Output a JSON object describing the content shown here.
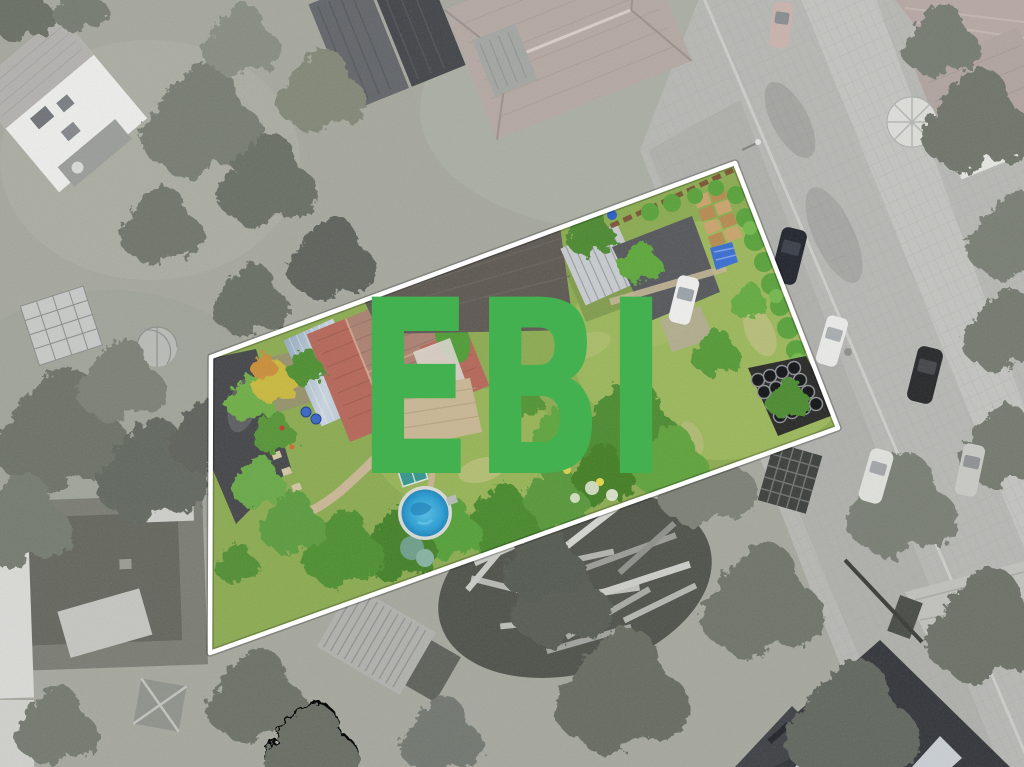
{
  "scene": {
    "description": "Aerial drone photograph of a residential neighborhood; surroundings desaturated to grayscale, the listed parcel shown in full color inside a white boundary outline, with a large green watermark.",
    "watermark": {
      "text": "EBI",
      "color": "#44b150"
    },
    "parcel": {
      "boundary_points": "211,357 735,163 838,428 210,653",
      "boundary_color": "#ffffff",
      "boundary_width": 4.5
    },
    "palette": {
      "outside_ground": "#a6a89e",
      "road_paving": "#b7b8b4",
      "parcel_lawn": "#8cab52",
      "main_house_roof": "#ab8272",
      "roof_red_tiles": "#b5685a",
      "barn_roof": "#5e5953",
      "metal_shed_roof": "#9fb3c4",
      "light_shed_roof": "#c7cbce",
      "garage_roof": "#46474a",
      "patio_paving": "#c9b795",
      "pool_water": "#2d9fd4",
      "pool_rim": "#d8dad6",
      "hedge_green": "#5aa23c",
      "tarp_blue": "#3a6fd0"
    }
  }
}
